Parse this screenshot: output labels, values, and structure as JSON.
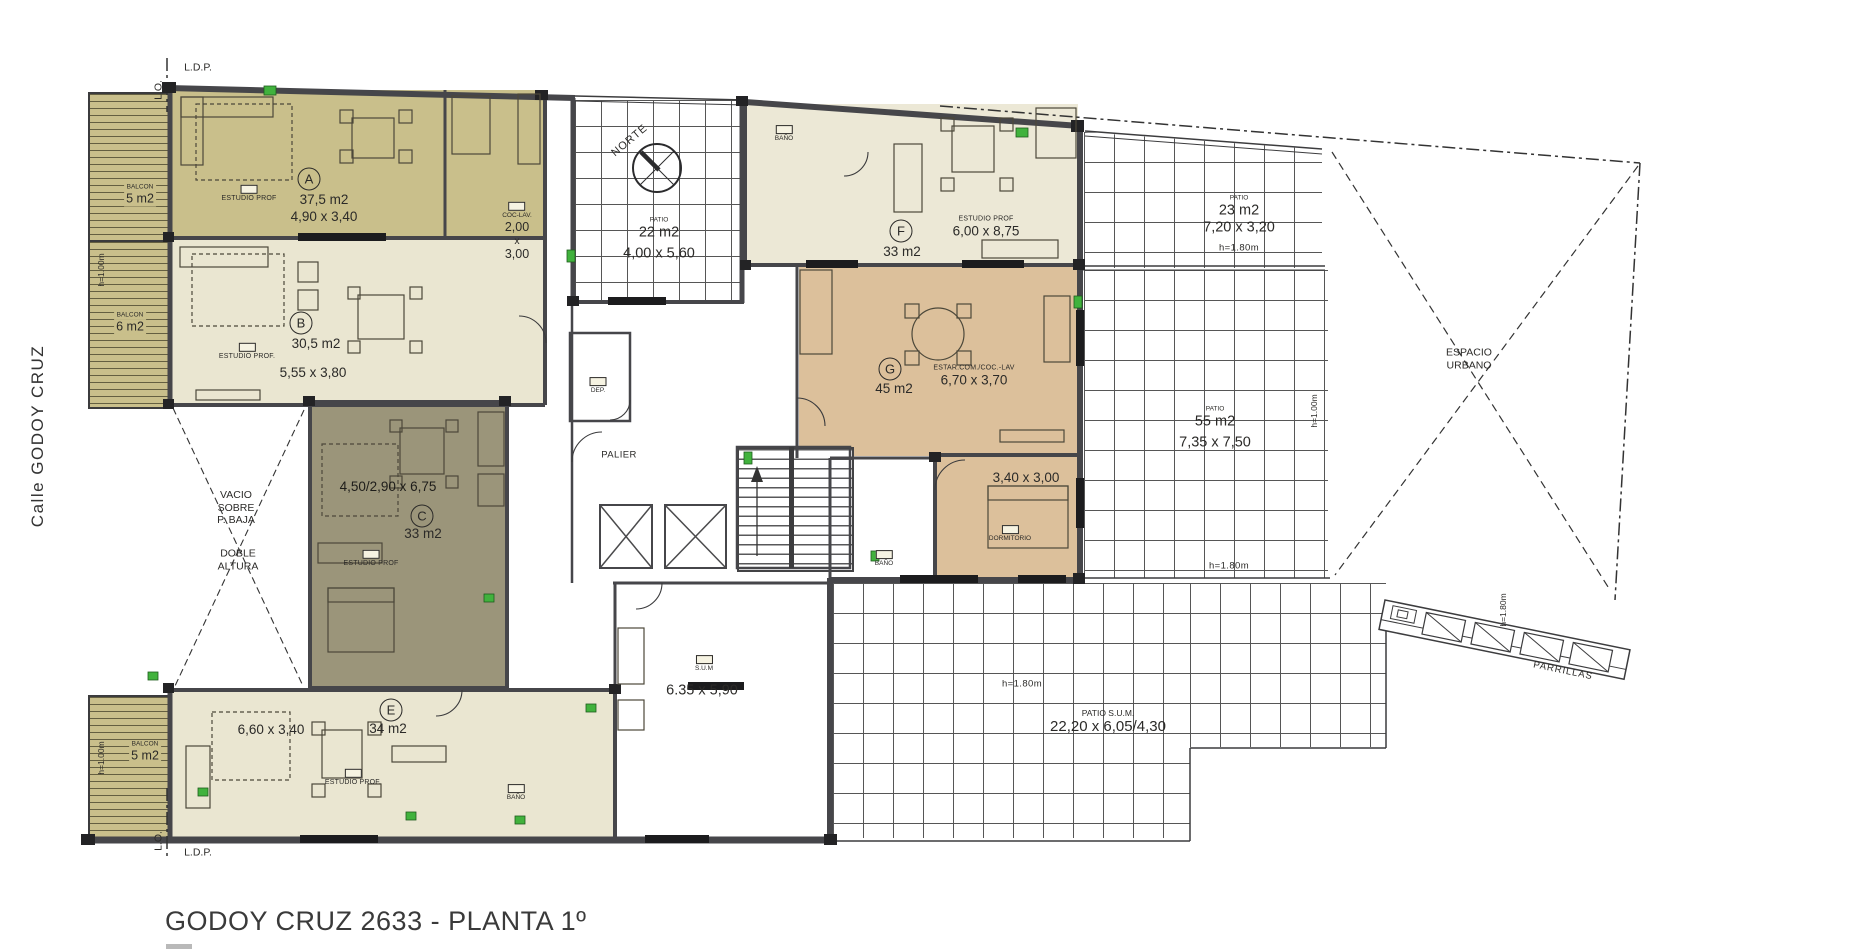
{
  "title": "GODOY CRUZ 2633 - PLANTA 1º",
  "street": "Calle  GODOY CRUZ",
  "boundary": {
    "ldp_top": "L.D.P.",
    "lo_top": "L.O.",
    "lo_bottom": "L.O.",
    "ldp_bottom": "L.D.P."
  },
  "compass": {
    "label": "NORTE"
  },
  "units": [
    {
      "id": "A",
      "area": "37,5 m2",
      "dims": "4,90 x 3,40",
      "room": "ESTUDIO PROF"
    },
    {
      "id": "B",
      "area": "30,5 m2",
      "dims": "5,55 x 3,80",
      "room": "ESTUDIO PROF."
    },
    {
      "id": "C",
      "area": "33 m2",
      "dims": "4,50/2,90 x 6,75",
      "room": "ESTUDIO PROF"
    },
    {
      "id": "E",
      "area": "34 m2",
      "dims": "6,60 x 3,40",
      "room": "ESTUDIO PROF."
    },
    {
      "id": "F",
      "area": "33 m2",
      "dims": "6,00 x 8,75",
      "room": "ESTUDIO PROF"
    },
    {
      "id": "G",
      "area": "45 m2",
      "dims": "6,70 x 3,70",
      "room": "ESTAR.COM./COC.-LAV"
    }
  ],
  "rooms": {
    "coclav": {
      "name": "COC-LAV.",
      "w": "2,00",
      "x": "x",
      "h": "3,00"
    },
    "dormitorio": {
      "name": "DORMITORIO",
      "dims": "3,40 x 3,00"
    },
    "dep": "DEP.",
    "palier": "PALIER",
    "sum": {
      "name": "S.U.M",
      "dims": "6.35 x 5,90"
    },
    "banio": "BAÑO"
  },
  "patios": [
    {
      "name": "PATIO",
      "area": "22 m2",
      "dims": "4,00 x 5,60"
    },
    {
      "name": "PATIO",
      "area": "23 m2",
      "dims": "7,20 x 3,20",
      "h": "h=1.80m"
    },
    {
      "name": "PATIO",
      "area": "55 m2",
      "dims": "7,35 x 7,50",
      "h": "h=1.80m"
    },
    {
      "name": "PATIO  S.U.M.",
      "dims": "22,20 x 6,05/4,30",
      "h": "h=1.80m"
    }
  ],
  "balconies": [
    {
      "name": "BALCON",
      "area": "5 m2",
      "h": "h=1.00m"
    },
    {
      "name": "BALCON",
      "area": "6 m2"
    },
    {
      "name": "BALCON",
      "area": "5 m2",
      "h": "h=1.00m"
    }
  ],
  "heights": {
    "h100": "h=1.00m",
    "h180": "h=1.80m"
  },
  "outdoor": {
    "espacio": "ESPACIO",
    "urbano": "URBANO",
    "parrillas": "PARRILLAS"
  },
  "vacio": {
    "l1": "VACIO",
    "l2": "SOBRE",
    "l3": "P. BAJA",
    "l4": "DOBLE",
    "l5": "ALTURA"
  }
}
